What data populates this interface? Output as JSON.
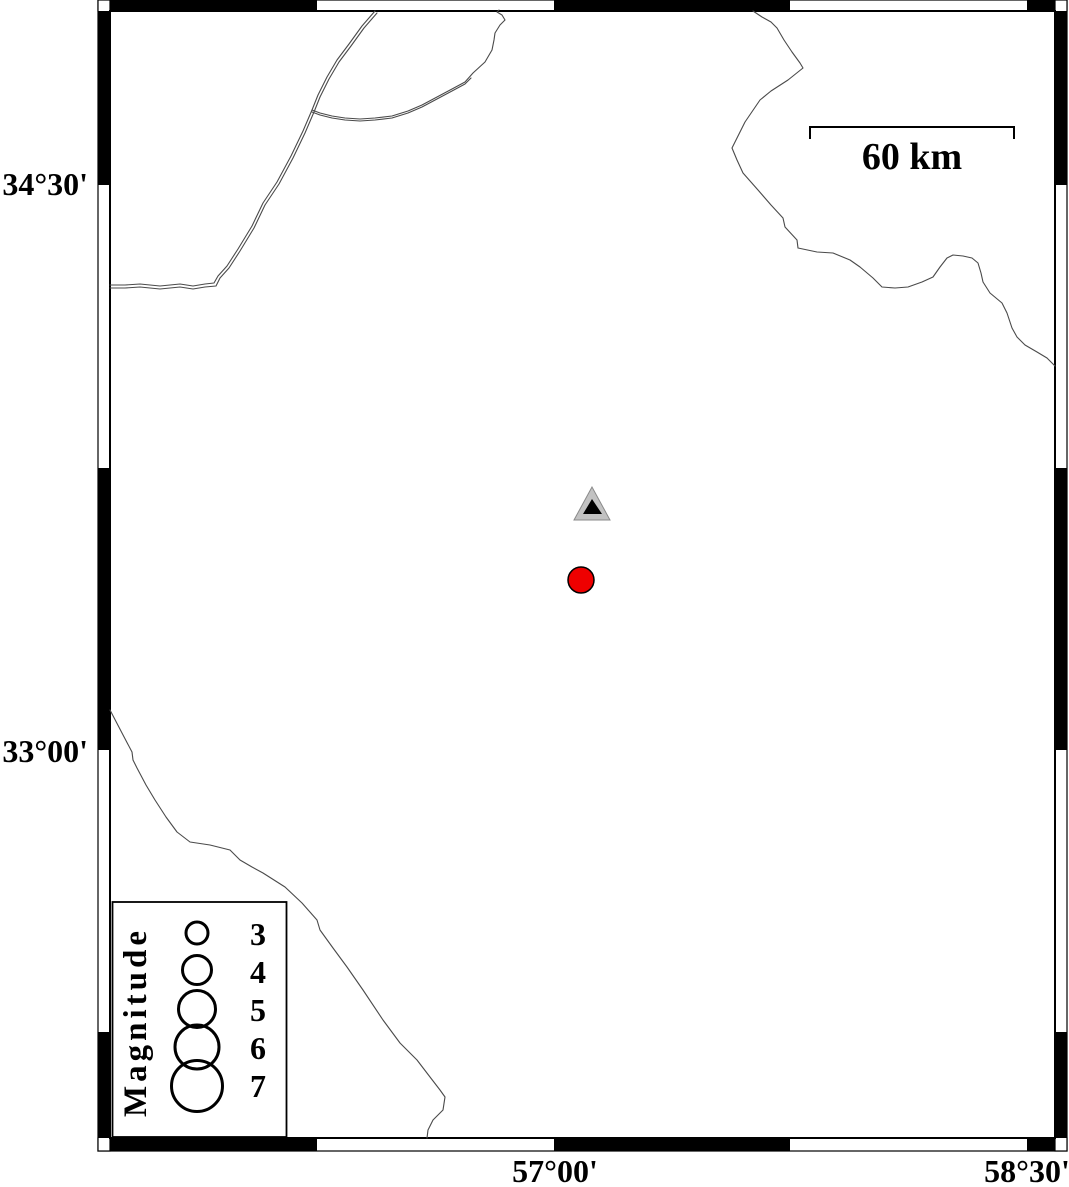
{
  "axis_labels": {
    "latitude": [
      "34°30'",
      "33°00'"
    ],
    "longitude": [
      "57°00'",
      "58°30'"
    ]
  },
  "scale_bar": {
    "label": "60 km"
  },
  "legend": {
    "title": "Magnitude",
    "entries": [
      {
        "label": "3"
      },
      {
        "label": "4"
      },
      {
        "label": "5"
      },
      {
        "label": "6"
      },
      {
        "label": "7"
      }
    ]
  },
  "markers": {
    "epicenter": {
      "shape": "circle",
      "color": "#ee0000"
    },
    "station": {
      "shape": "triangle",
      "fill": "#c2c2c2"
    }
  },
  "colors": {
    "frame": "#000000",
    "boundary": "#4a4a4a"
  }
}
